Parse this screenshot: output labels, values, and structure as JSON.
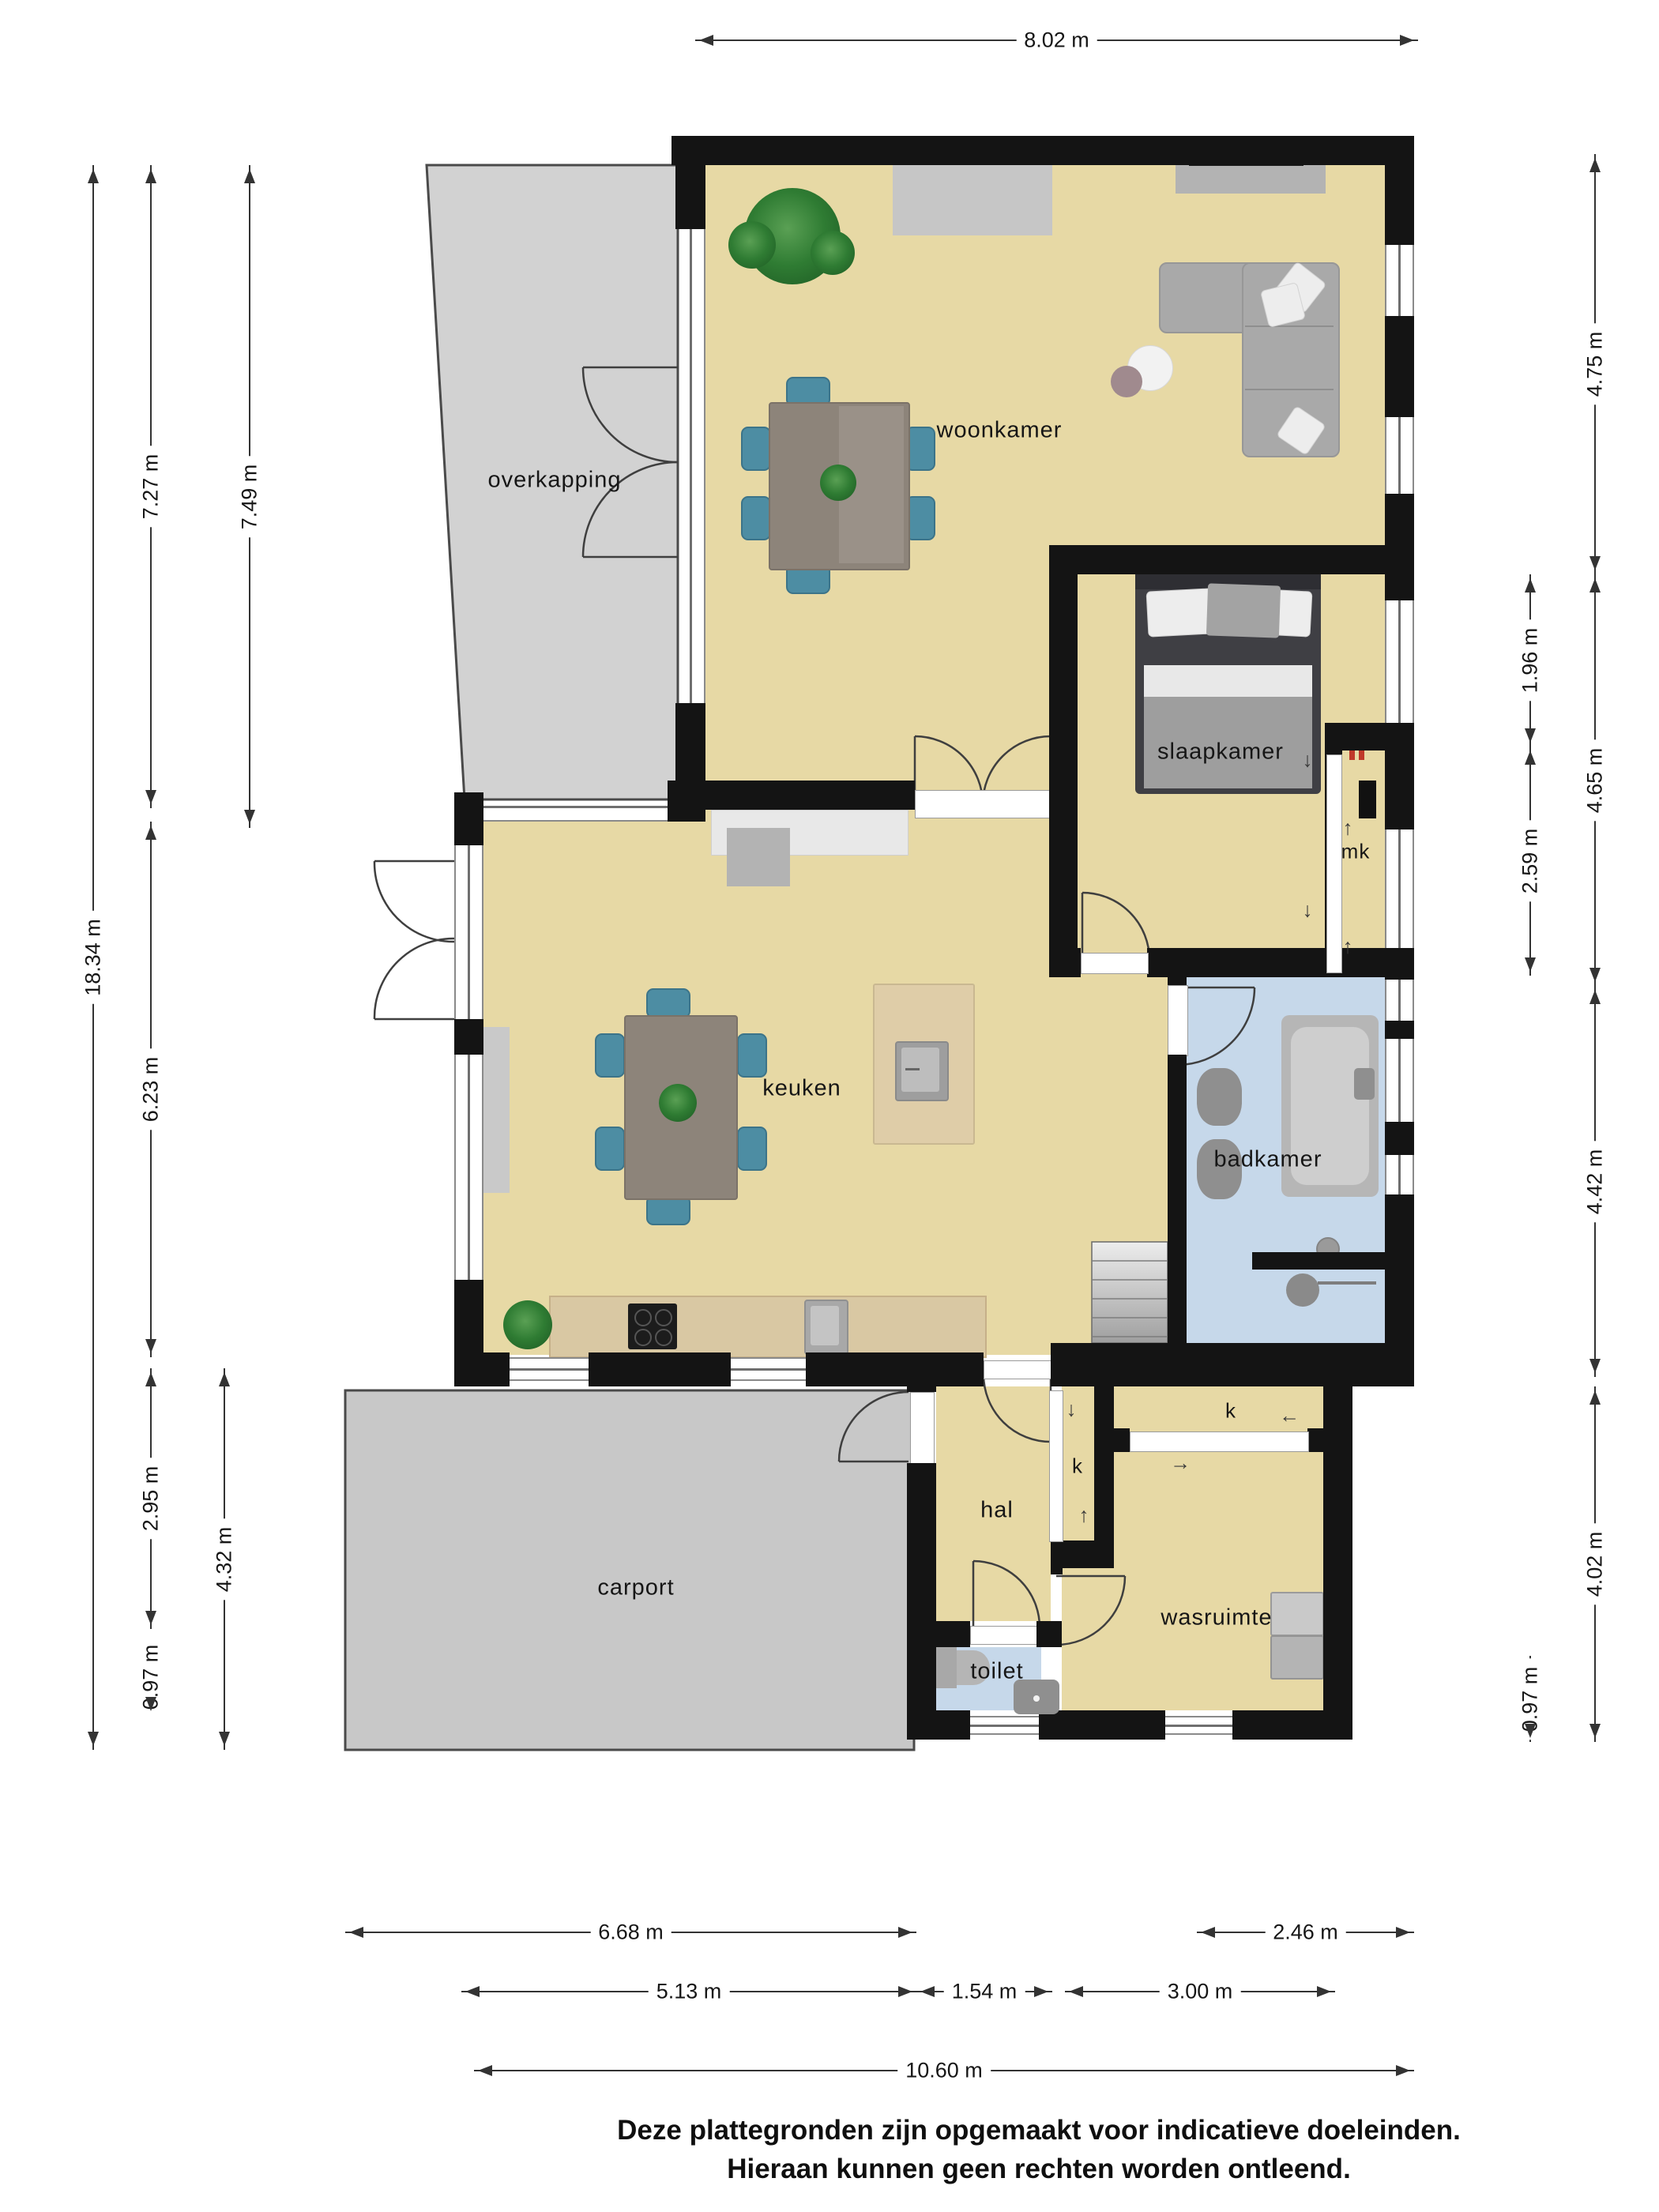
{
  "floorplan": {
    "rooms": {
      "overkapping": "overkapping",
      "woonkamer": "woonkamer",
      "slaapkamer": "slaapkamer",
      "mk": "mk",
      "keuken": "keuken",
      "badkamer": "badkamer",
      "hal": "hal",
      "k1": "k",
      "k2": "k",
      "carport": "carport",
      "wasruimte": "wasruimte",
      "toilet": "toilet"
    },
    "dimensions": {
      "top": {
        "d802": "8.02 m"
      },
      "left": {
        "d1834": "18.34 m",
        "d727": "7.27 m",
        "d749": "7.49 m",
        "d623": "6.23 m",
        "d295": "2.95 m",
        "d432": "4.32 m",
        "d097": "0.97 m"
      },
      "right": {
        "d475": "4.75 m",
        "d196": "1.96 m",
        "d465": "4.65 m",
        "d259": "2.59 m",
        "d442": "4.42 m",
        "d402": "4.02 m",
        "d097": "0.97 m"
      },
      "bottom": {
        "d668": "6.68 m",
        "d246": "2.46 m",
        "d513": "5.13 m",
        "d154": "1.54 m",
        "d300": "3.00 m",
        "d1060": "10.60 m"
      }
    },
    "icons": {
      "arrow_down": "↓",
      "arrow_up": "↑",
      "arrow_left": "←",
      "arrow_right": "→"
    },
    "disclaimer": {
      "line1": "Deze plattegronden zijn opgemaakt voor indicatieve doeleinden.",
      "line2": "Hieraan kunnen geen rechten worden ontleend."
    },
    "colors": {
      "floor_beige": "#e7d9a5",
      "wet_room_blue": "#c6d8ea",
      "wall_black": "#141414",
      "overkapping_gray": "#d2d2d2",
      "carport_gray": "#c8c8c8",
      "wood_dark": "#8d847a",
      "chair_teal": "#4d8da3"
    }
  }
}
